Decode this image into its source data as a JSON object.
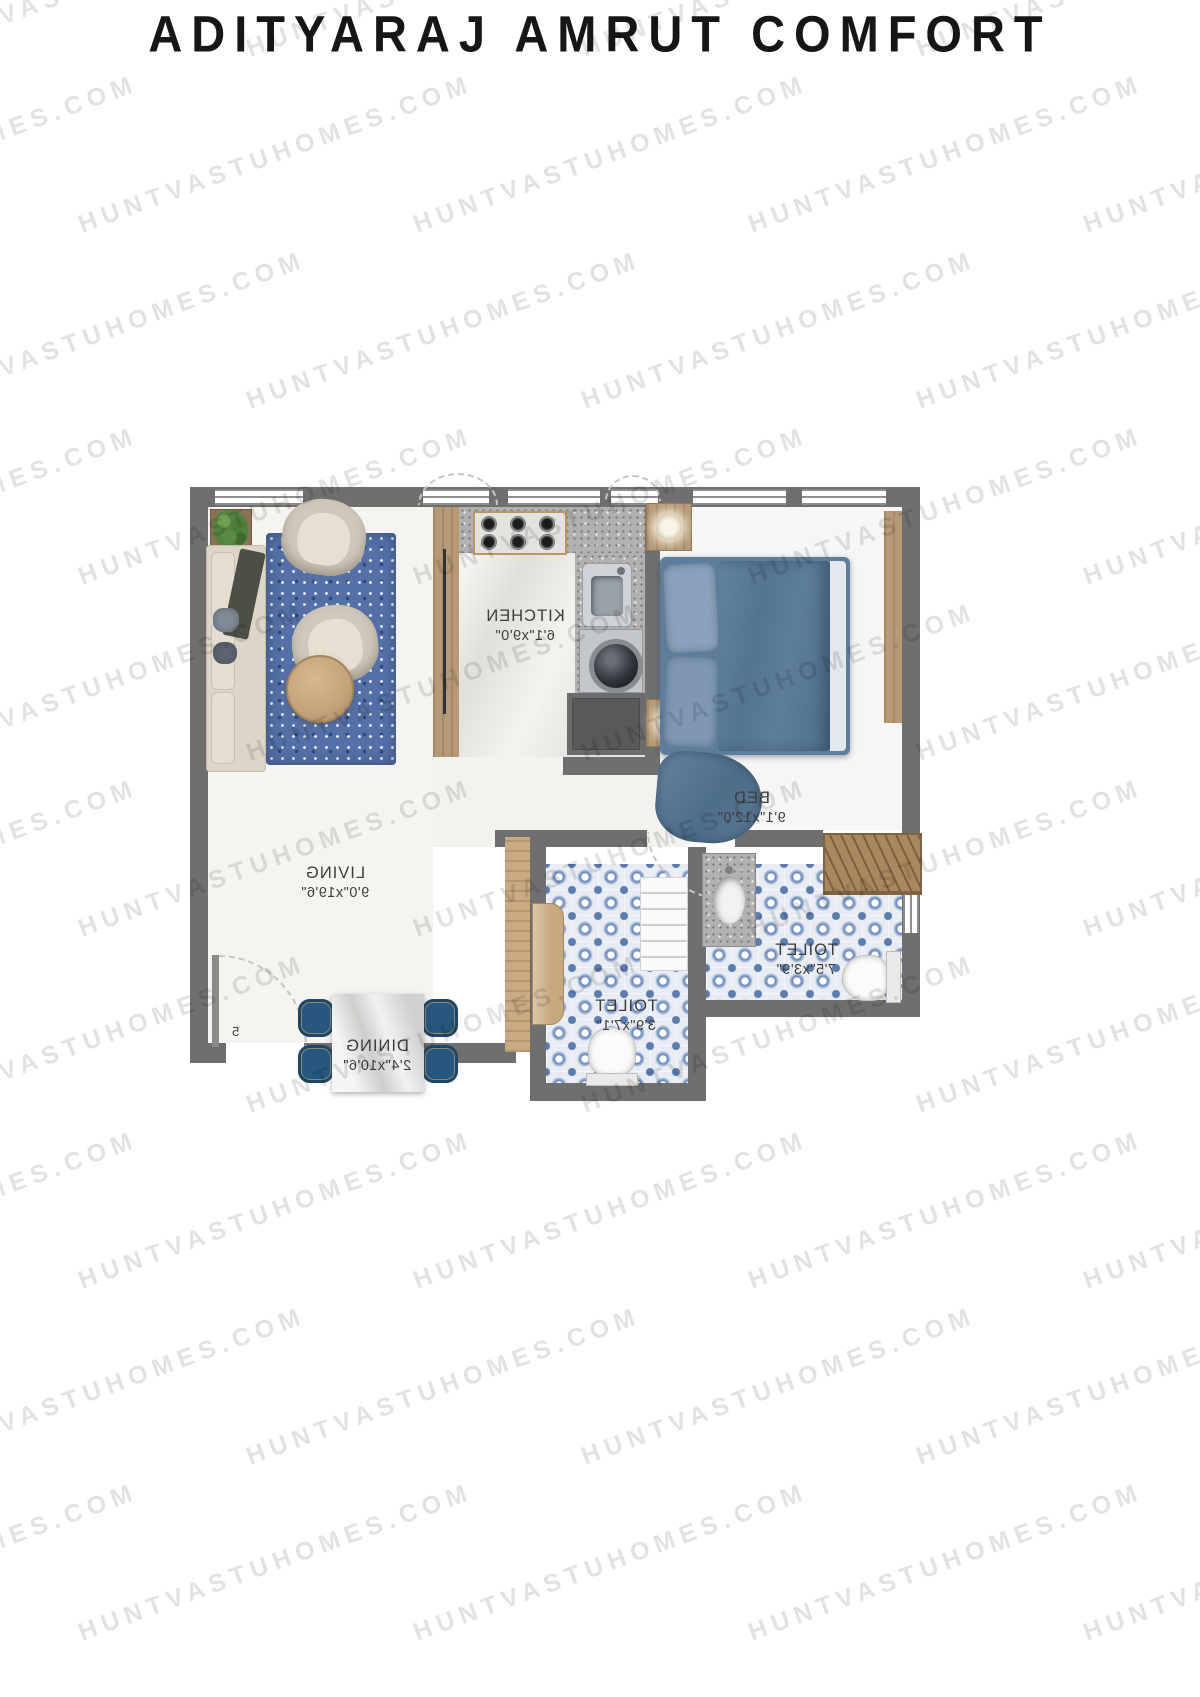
{
  "title": "ADITYARAJ AMRUT COMFORT",
  "watermark": {
    "text": "HUNTVASTUHOMES.COM"
  },
  "floor_plan": {
    "mirrored_text": true,
    "unit_label": "5",
    "rooms": [
      {
        "id": "living",
        "name": "LIVING",
        "dimensions": "9'0\"x19'6\""
      },
      {
        "id": "kitchen",
        "name": "KITCHEN",
        "dimensions": "6'1\"x9'0\""
      },
      {
        "id": "bed",
        "name": "BED",
        "dimensions": "9'1\"x12'0\""
      },
      {
        "id": "toilet_1",
        "name": "TOILET",
        "dimensions": "7'5\"x3'9\""
      },
      {
        "id": "toilet_2",
        "name": "TOILET",
        "dimensions": "3'9\"x7'1\""
      },
      {
        "id": "dining",
        "name": "DINING",
        "dimensions": "2'4\"x10'6\""
      }
    ],
    "colors": {
      "wall": "#6f6f6f",
      "wood": "#b59a78",
      "tile_blue": "#4a6fae",
      "bed_blue": "#5e7d9a",
      "chair_blue": "#27567e",
      "rug_blue": "#5470a6",
      "plant_green": "#5a8a44",
      "watermark_gray": "#d9d9d9"
    }
  }
}
